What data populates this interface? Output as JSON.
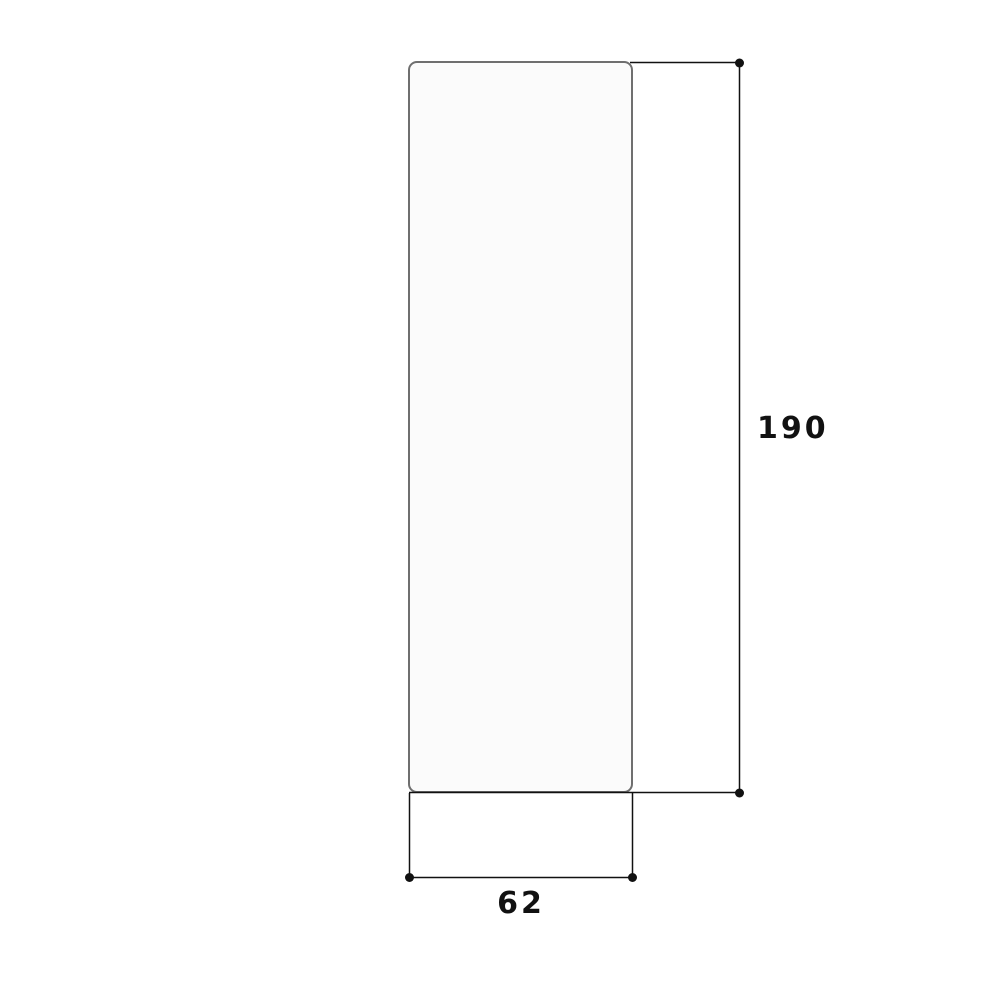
{
  "diagram": {
    "type": "dimension-drawing",
    "subject": "tall rounded-rectangle panel, front elevation view",
    "height_dimension": {
      "label": "190",
      "orientation": "vertical",
      "position": "right-of-panel"
    },
    "width_dimension": {
      "label": "62",
      "orientation": "horizontal",
      "position": "below-panel"
    },
    "colors": {
      "background": "#ffffff",
      "dimension_line": "#111111",
      "panel_border": "#6f6f6f",
      "panel_fill": "#fbfbfb",
      "label_text": "#111111"
    }
  }
}
